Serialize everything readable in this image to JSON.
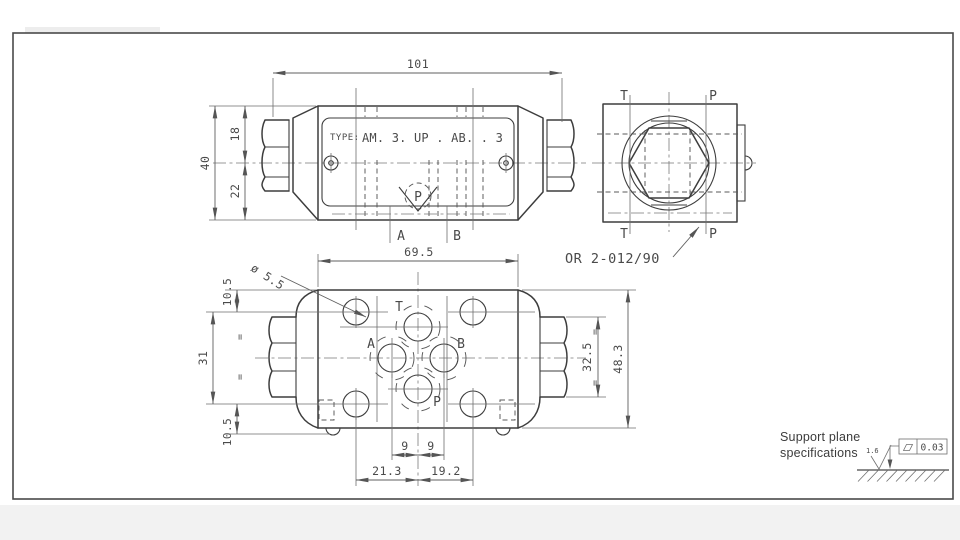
{
  "front": {
    "type_prefix": "TYPE:",
    "type_value": "AM. 3. UP . AB. . 3",
    "port_a": "A",
    "port_b": "B",
    "check_port": "P",
    "dim_length": "101",
    "dim_height": "40",
    "dim_upper": "18",
    "dim_lower": "22"
  },
  "side": {
    "label_t_top": "T",
    "label_p_top": "P",
    "label_t_bottom": "T",
    "label_p_bottom": "P",
    "oring": "OR 2-012/90"
  },
  "bottom": {
    "port_t": "T",
    "port_a": "A",
    "port_b": "B",
    "port_p": "P",
    "dim_width": "69.5",
    "dim_hole": "ø 5.5",
    "dim_top_offset": "10.5",
    "dim_hole_span": "31",
    "dim_bottom_offset": "10.5",
    "dim_nut_span": "32.5",
    "dim_height": "48.3",
    "dim_nine_left": "9",
    "dim_nine_right": "9",
    "dim_left_span": "21.3",
    "dim_right_span": "19.2",
    "equal_mark": "="
  },
  "support": {
    "line1": "Support plane",
    "line2": "specifications",
    "roughness": "1.6",
    "flatness": "0.03"
  }
}
